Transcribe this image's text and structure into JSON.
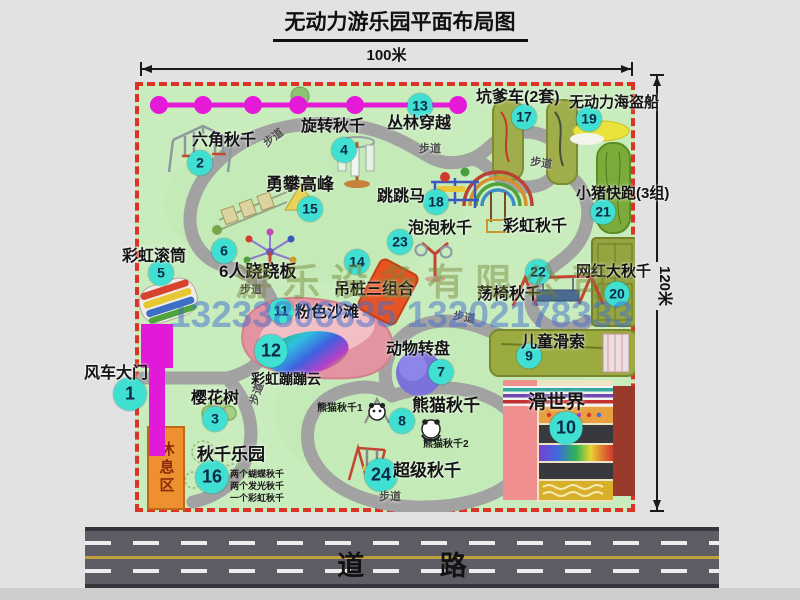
{
  "title": "无动力游乐园平面布局图",
  "dimensions": {
    "width_label": "100米",
    "height_label": "120米"
  },
  "road": {
    "label": "道 路"
  },
  "watermark": {
    "company": "游乐设备有限公司",
    "phone": "13233806635 13202178333"
  },
  "rest_area": {
    "label": "休息区"
  },
  "colors": {
    "park_green": "#c9ecbd",
    "border_red": "#dd3326",
    "badge_cyan": "#3fdfd2",
    "gate_magenta": "#e01ad8",
    "zipline_magenta": "#e51ad8",
    "walkway_gray": "#a2a2a2",
    "road_gray": "#5e5c64",
    "rest_orange": "#ef9030",
    "olive_green": "#9fae4a"
  },
  "attractions": [
    {
      "num": "1",
      "name": "风车大门",
      "badge": [
        130,
        394
      ],
      "label": [
        84,
        366
      ],
      "size": 16,
      "big": true
    },
    {
      "num": "2",
      "name": "六角秋千",
      "badge": [
        200,
        163
      ],
      "label": [
        192,
        133
      ],
      "size": 16
    },
    {
      "num": "3",
      "name": "樱花树",
      "badge": [
        215,
        419
      ],
      "label": [
        191,
        391
      ],
      "size": 16
    },
    {
      "num": "4",
      "name": "旋转秋千",
      "badge": [
        344,
        150
      ],
      "label": [
        301,
        119
      ],
      "size": 16
    },
    {
      "num": "5",
      "name": "彩虹滚筒",
      "badge": [
        161,
        273
      ],
      "label": [
        122,
        249
      ],
      "size": 16
    },
    {
      "num": "6",
      "name": "6人跷跷板",
      "badge": [
        224,
        251
      ],
      "label": [
        219,
        263
      ],
      "size": 17
    },
    {
      "num": "7",
      "name": "动物转盘",
      "badge": [
        441,
        372
      ],
      "label": [
        386,
        342
      ],
      "size": 16
    },
    {
      "num": "8",
      "name": "熊猫秋千",
      "badge": [
        402,
        421
      ],
      "label": [
        412,
        397
      ],
      "size": 17
    },
    {
      "num": "9",
      "name": "儿童滑索",
      "badge": [
        529,
        356
      ],
      "label": [
        521,
        335
      ],
      "size": 16
    },
    {
      "num": "10",
      "name": "滑世界",
      "badge": [
        566,
        428
      ],
      "label": [
        528,
        393
      ],
      "size": 19,
      "big": true
    },
    {
      "num": "11",
      "name": "粉色沙滩",
      "badge": [
        281,
        311
      ],
      "label": [
        295,
        305
      ],
      "size": 16
    },
    {
      "num": "12",
      "name": "彩虹蹦蹦云",
      "badge": [
        271,
        351
      ],
      "label": [
        251,
        372
      ],
      "size": 14,
      "big": true
    },
    {
      "num": "13",
      "name": "丛林穿越",
      "badge": [
        420,
        106
      ],
      "label": [
        387,
        116
      ],
      "size": 16
    },
    {
      "num": "14",
      "name": "吊桩三组合",
      "badge": [
        357,
        262
      ],
      "label": [
        334,
        282
      ],
      "size": 16
    },
    {
      "num": "15",
      "name": "勇攀高峰",
      "badge": [
        310,
        209
      ],
      "label": [
        266,
        176
      ],
      "size": 17
    },
    {
      "num": "16",
      "name": "秋千乐园",
      "badge": [
        212,
        477
      ],
      "label": [
        197,
        446
      ],
      "size": 17,
      "big": true,
      "notes": [
        "两个蝴蝶秋千",
        "两个发光秋千",
        "一个彩虹秋千"
      ],
      "notes_pos": [
        230,
        468
      ]
    },
    {
      "num": "17",
      "name": "坑爹车(2套)",
      "badge": [
        524,
        117
      ],
      "label": [
        476,
        90
      ],
      "size": 16
    },
    {
      "num": "18",
      "name": "跳跳马",
      "badge": [
        436,
        202
      ],
      "label": [
        377,
        189
      ],
      "size": 16
    },
    {
      "num": "19",
      "name": "无动力海盗船",
      "badge": [
        589,
        119
      ],
      "label": [
        569,
        95
      ],
      "size": 15
    },
    {
      "num": "20",
      "name": "网红大秋千",
      "badge": [
        617,
        294
      ],
      "label": [
        576,
        264
      ],
      "size": 15
    },
    {
      "num": "21",
      "name": "小猪快跑(3组)",
      "badge": [
        603,
        212
      ],
      "label": [
        576,
        186
      ],
      "size": 15
    },
    {
      "num": "22",
      "name": "荡椅秋千",
      "badge": [
        538,
        272
      ],
      "label": [
        477,
        287
      ],
      "size": 16
    },
    {
      "num": "23",
      "name": "泡泡秋千",
      "badge": [
        400,
        242
      ],
      "label": [
        408,
        221
      ],
      "size": 16
    },
    {
      "num": "24",
      "name": "超级秋千",
      "badge": [
        381,
        475
      ],
      "label": [
        393,
        462
      ],
      "size": 17,
      "big": true
    },
    {
      "key": "rainbow-swing",
      "name": "彩虹秋千",
      "label": [
        503,
        219
      ],
      "size": 16
    }
  ],
  "small_labels": [
    {
      "text": "熊猫秋千1",
      "x": 317,
      "y": 404
    },
    {
      "text": "熊猫秋千2",
      "x": 423,
      "y": 440
    }
  ],
  "walkway_labels": {
    "text": "步道",
    "positions": [
      [
        262,
        141,
        -38
      ],
      [
        419,
        144,
        0
      ],
      [
        531,
        157,
        8
      ],
      [
        240,
        285,
        0
      ],
      [
        454,
        311,
        10
      ],
      [
        249,
        403,
        -72
      ],
      [
        379,
        492,
        0
      ]
    ]
  }
}
